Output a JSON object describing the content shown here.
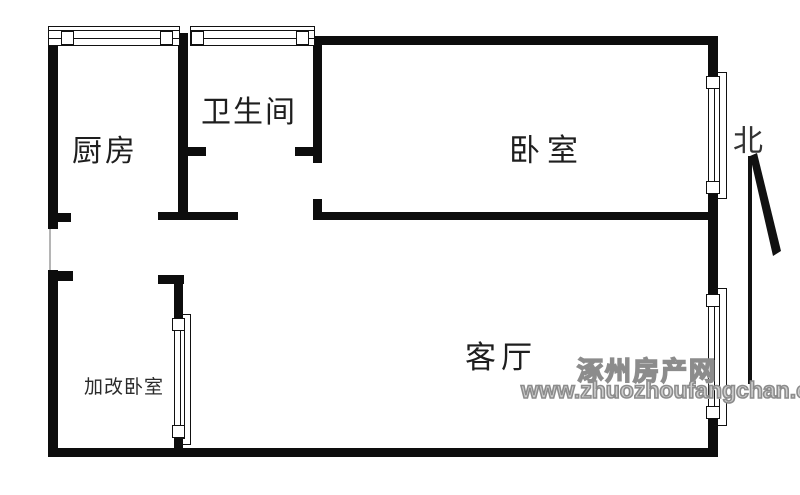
{
  "floorplan": {
    "rooms": [
      {
        "name": "kitchen",
        "label": "厨房"
      },
      {
        "name": "bathroom",
        "label": "卫生间"
      },
      {
        "name": "bedroom",
        "label": "卧室"
      },
      {
        "name": "living-room",
        "label": "客厅"
      },
      {
        "name": "converted-bedroom",
        "label": "加改卧室"
      }
    ],
    "compass": {
      "north_label": "北",
      "arrow_icon": "north-arrow-icon"
    },
    "watermark": {
      "site_name": "涿州房产网",
      "site_url": "www.zhuozhoufangchan.com"
    },
    "colors": {
      "wall": "#0d0d0d",
      "background": "#ffffff",
      "watermark_gray": "#8c8c8c"
    }
  }
}
